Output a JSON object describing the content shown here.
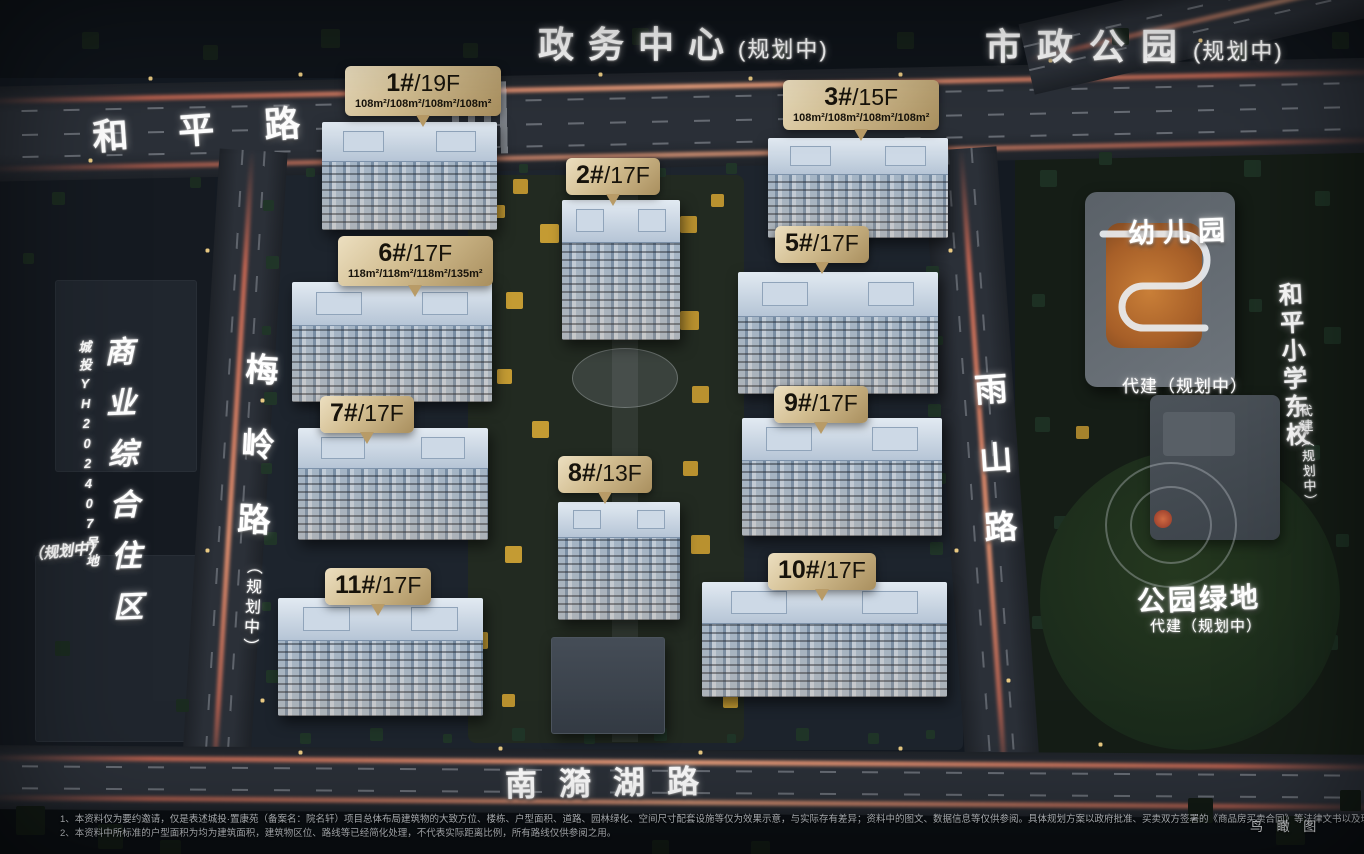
{
  "districts": {
    "gov_center": {
      "name": "政务中心",
      "status": "(规划中)"
    },
    "city_park": {
      "name": "市政公园",
      "status": "(规划中)"
    },
    "commercial": {
      "name": "商业综合住区",
      "plot_code": "城投YH202407号地",
      "status": "（规划中）"
    },
    "kindergarten": {
      "name": "幼儿园",
      "note": "代建（规划中）"
    },
    "school": {
      "name": "和平小学东校",
      "note": "代建（规划中）"
    },
    "green_park": {
      "name": "公园绿地",
      "note": "代建（规划中）"
    }
  },
  "roads": {
    "north": {
      "name": "和平路"
    },
    "west": {
      "name": "梅岭路",
      "status": "（规划中）"
    },
    "east": {
      "name": "雨山路"
    },
    "south": {
      "name": "南漪湖路"
    }
  },
  "buildings": [
    {
      "id": "1#",
      "floors": "/19F",
      "areas": "108m²/108m²/108m²/108m²"
    },
    {
      "id": "2#",
      "floors": "/17F",
      "areas": ""
    },
    {
      "id": "3#",
      "floors": "/15F",
      "areas": "108m²/108m²/108m²/108m²"
    },
    {
      "id": "5#",
      "floors": "/17F",
      "areas": ""
    },
    {
      "id": "6#",
      "floors": "/17F",
      "areas": "118m²/118m²/118m²/135m²"
    },
    {
      "id": "7#",
      "floors": "/17F",
      "areas": ""
    },
    {
      "id": "8#",
      "floors": "/13F",
      "areas": ""
    },
    {
      "id": "9#",
      "floors": "/17F",
      "areas": ""
    },
    {
      "id": "10#",
      "floors": "/17F",
      "areas": ""
    },
    {
      "id": "11#",
      "floors": "/17F",
      "areas": ""
    }
  ],
  "footer": {
    "disclaimer_line1": "1、本资料仅为要约邀请，仅是表述城投·置康苑（备案名：院名轩）项目总体布局建筑物的大致方位、楼栋、户型面积、道路、园林绿化、空间尺寸配套设施等仅为效果示意，与实际存有差异；资料中的图文、数据信息等仅供参阅。具体规划方案以政府批准、买卖双方签署的《商品房买卖合同》等法律文书以及现场实际交付的为准；",
    "disclaimer_line2": "2、本资料中所标准的户型面积为均为建筑面积，建筑物区位、路线等已经简化处理，不代表实际距离比例，所有路线仅供参阅之用。",
    "view_label": "鸟 瞰 图"
  },
  "colors": {
    "tag_gold": "#d2bd90",
    "tag_text": "#17130b",
    "traffic_glow": "#f4765a"
  }
}
